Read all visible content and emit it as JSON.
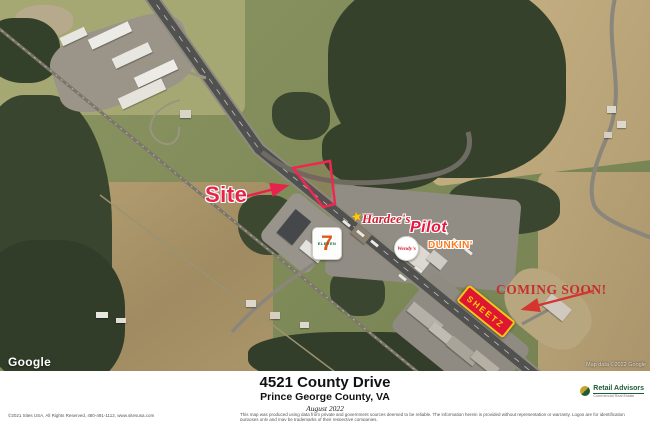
{
  "map": {
    "annotations": {
      "site_label": "Site",
      "coming_soon_label": "COMING SOON!"
    },
    "pois": {
      "seven_eleven": {
        "numeral": "7",
        "word": "ELEVEN"
      },
      "hardees": {
        "label": "Hardee's"
      },
      "pilot": {
        "label": "Pilot"
      },
      "wendys": {
        "label": "Wendy's"
      },
      "dunkin": {
        "label": "DUNKIN'"
      },
      "sheetz": {
        "label": "SHEETZ"
      }
    },
    "icons": {
      "hardees_star": "★"
    },
    "attribution": {
      "google_logo": "Google",
      "map_data": "Map data ©2022 Google"
    },
    "colors": {
      "annotation_red": "#e8234b",
      "coming_soon_red": "#c5302e",
      "parcel_outline": "#ee2950",
      "sheetz_red": "#de1634",
      "sheetz_gold": "#ffd100",
      "dunkin_orange": "#ff7a1a",
      "pilot_red": "#e8173f"
    }
  },
  "footer": {
    "title": "4521 County Drive",
    "subtitle": "Prince George County, VA",
    "date": "August 2022",
    "copyright": "©2021 Sites USA, All Rights Reserved, 480-491-1112, www.sitesusa.com",
    "disclaimer": "This map was produced using data from private and government sources deemed to be reliable. The information herein is provided without representation or warranty. Logos are for identification purposes only and may be trademarks of their respective companies.",
    "brand": {
      "name": "Retail Advisors",
      "tagline": "Commercial Real Estate"
    }
  }
}
